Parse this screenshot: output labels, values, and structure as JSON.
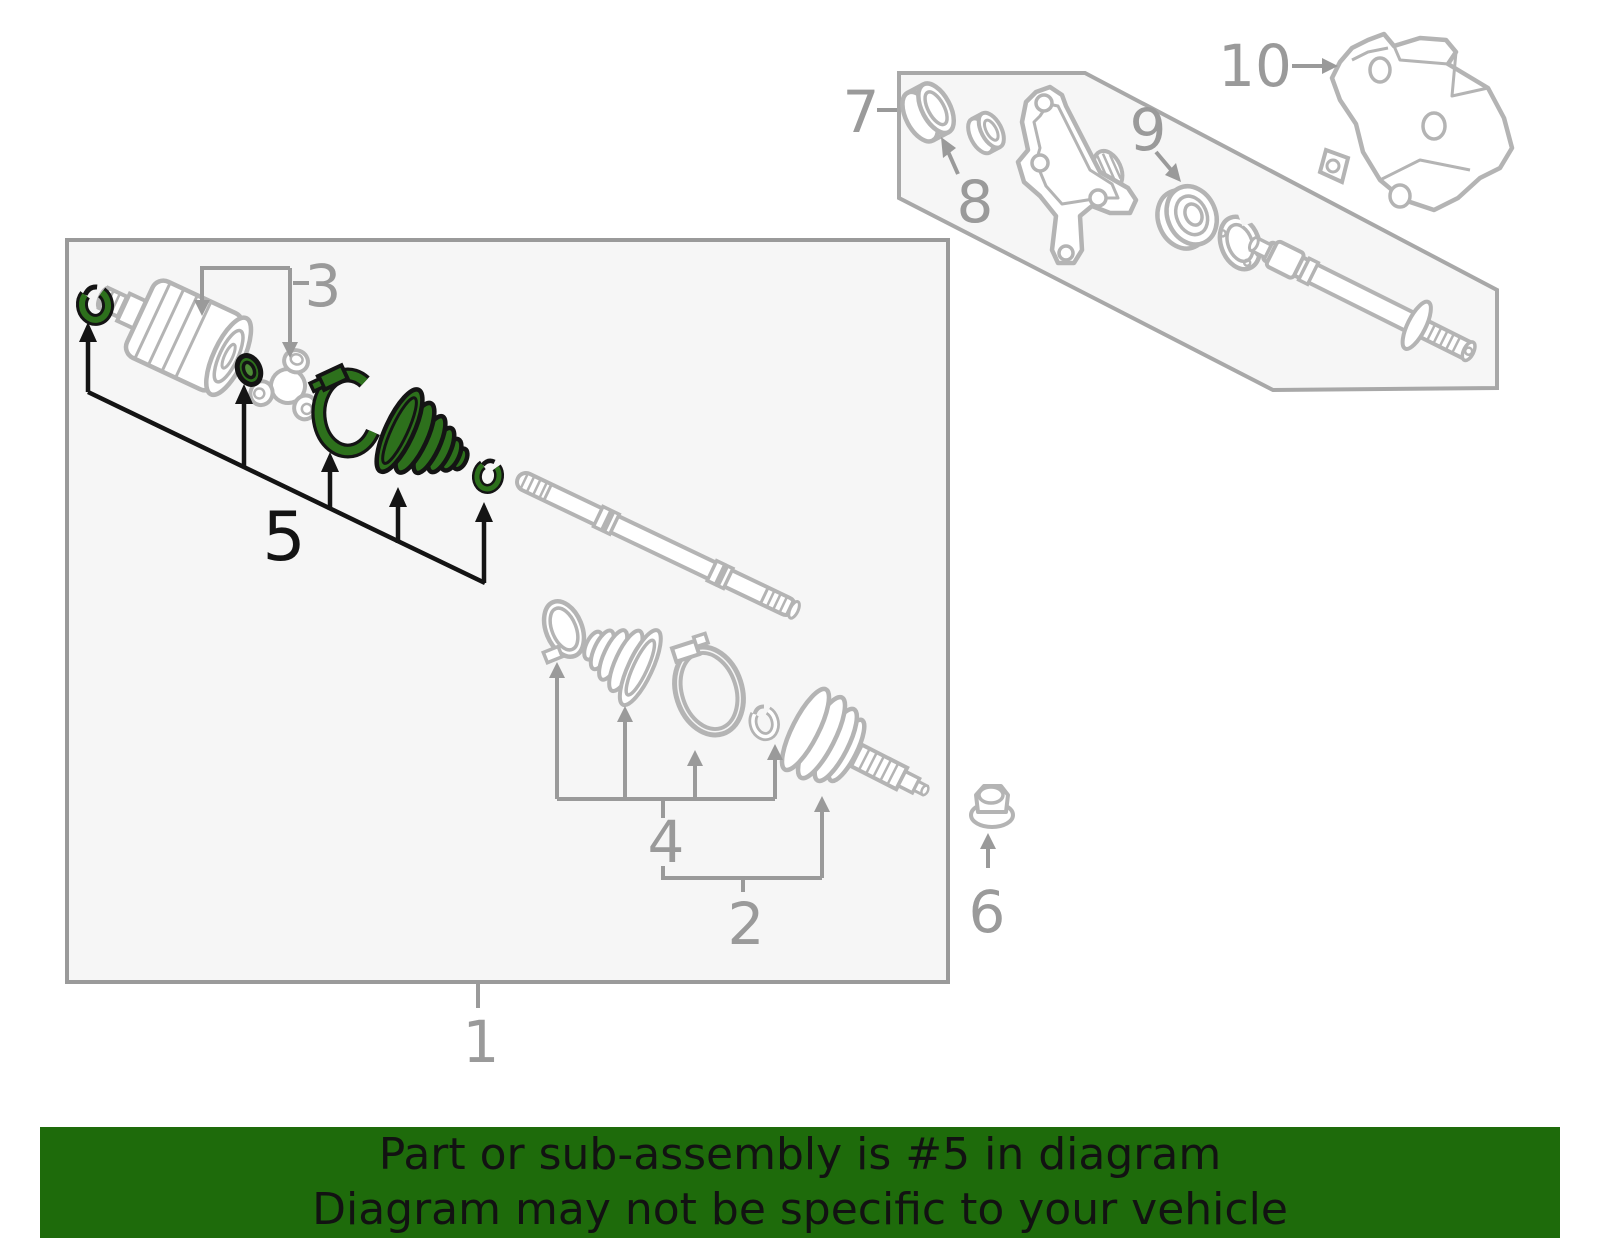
{
  "banner": {
    "line1": "Part or sub-assembly is #5 in diagram",
    "line2": "Diagram may not be specific to your vehicle",
    "bg_color": "#1e6b0b",
    "text_color": "#121212"
  },
  "diagram": {
    "highlighted_callout": "5",
    "highlight_color": "#2d701c",
    "gray_art_color": "#b4b4b4",
    "callout_color": "#9a9a9a",
    "black_color": "#141414",
    "panel_fill": "#f6f6f6",
    "callout_numbers": [
      "1",
      "2",
      "3",
      "4",
      "5",
      "6",
      "7",
      "8",
      "9",
      "10"
    ]
  }
}
